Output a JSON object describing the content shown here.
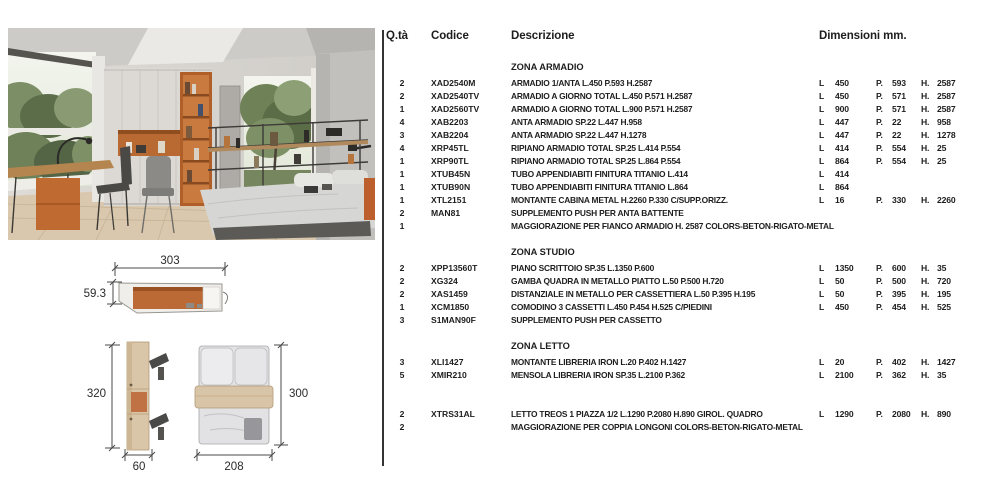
{
  "table": {
    "header": {
      "qty": "Q.tà",
      "code": "Codice",
      "desc": "Descrizione",
      "dims": "Dimensioni mm."
    },
    "dim_labels": {
      "l": "L",
      "p": "P.",
      "h": "H."
    },
    "sections": [
      {
        "title": "ZONA ARMADIO",
        "rows": [
          {
            "qty": "2",
            "code": "XAD2540M",
            "desc": "ARMADIO 1/ANTA  L.450 P.593 H.2587",
            "l": "450",
            "p": "593",
            "h": "2587"
          },
          {
            "qty": "2",
            "code": "XAD2540TV",
            "desc": "ARMADIO A GIORNO TOTAL L.450 P.571 H.2587",
            "l": "450",
            "p": "571",
            "h": "2587"
          },
          {
            "qty": "1",
            "code": "XAD2560TV",
            "desc": "ARMADIO A GIORNO TOTAL L.900 P.571 H.2587",
            "l": "900",
            "p": "571",
            "h": "2587"
          },
          {
            "qty": "4",
            "code": "XAB2203",
            "desc": "ANTA ARMADIO SP.22 L.447 H.958",
            "l": "447",
            "p": "22",
            "h": "958"
          },
          {
            "qty": "3",
            "code": "XAB2204",
            "desc": "ANTA ARMADIO SP.22 L.447 H.1278",
            "l": "447",
            "p": "22",
            "h": "1278"
          },
          {
            "qty": "4",
            "code": "XRP45TL",
            "desc": "RIPIANO ARMADIO TOTAL SP.25 L.414 P.554",
            "l": "414",
            "p": "554",
            "h": "25"
          },
          {
            "qty": "1",
            "code": "XRP90TL",
            "desc": "RIPIANO ARMADIO TOTAL SP.25 L.864 P.554",
            "l": "864",
            "p": "554",
            "h": "25"
          },
          {
            "qty": "1",
            "code": "XTUB45N",
            "desc": "TUBO APPENDIABITI FINITURA TITANIO L.414",
            "l": "414",
            "p": "",
            "h": ""
          },
          {
            "qty": "1",
            "code": "XTUB90N",
            "desc": "TUBO APPENDIABITI FINITURA TITANIO L.864",
            "l": "864",
            "p": "",
            "h": ""
          },
          {
            "qty": "1",
            "code": "XTL2151",
            "desc": "MONTANTE CABINA METAL H.2260 P.330 C/SUPP.ORIZZ.",
            "l": "16",
            "p": "330",
            "h": "2260"
          },
          {
            "qty": "2",
            "code": "MAN81",
            "desc": "SUPPLEMENTO PUSH PER ANTA BATTENTE",
            "l": "",
            "p": "",
            "h": ""
          },
          {
            "qty": "1",
            "code": "",
            "desc": "MAGGIORAZIONE PER FIANCO ARMADIO H. 2587 COLORS-BETON-RIGATO-METAL",
            "l": "",
            "p": "",
            "h": ""
          }
        ]
      },
      {
        "title": "ZONA STUDIO",
        "rows": [
          {
            "qty": "2",
            "code": "XPP13560T",
            "desc": "PIANO SCRITTOIO SP.35 L.1350 P.600",
            "l": "1350",
            "p": "600",
            "h": "35"
          },
          {
            "qty": "2",
            "code": "XG324",
            "desc": "GAMBA QUADRA IN METALLO PIATTO L.50 P.500 H.720",
            "l": "50",
            "p": "500",
            "h": "720"
          },
          {
            "qty": "2",
            "code": "XAS1459",
            "desc": "DISTANZIALE IN METALLO PER CASSETTIERA L.50 P.395 H.195",
            "l": "50",
            "p": "395",
            "h": "195"
          },
          {
            "qty": "1",
            "code": "XCM1850",
            "desc": "COMODINO 3 CASSETTI L.450 P.454 H.525 C/PIEDINI",
            "l": "450",
            "p": "454",
            "h": "525"
          },
          {
            "qty": "3",
            "code": "S1MAN90F",
            "desc": "SUPPLEMENTO PUSH PER CASSETTO",
            "l": "",
            "p": "",
            "h": ""
          }
        ]
      },
      {
        "title": "ZONA LETTO",
        "rows": [
          {
            "qty": "3",
            "code": "XLI1427",
            "desc": "MONTANTE LIBRERIA IRON L.20 P.402 H.1427",
            "l": "20",
            "p": "402",
            "h": "1427"
          },
          {
            "qty": "5",
            "code": "XMIR210",
            "desc": "MENSOLA LIBRERIA IRON SP.35 L.2100 P.362",
            "l": "2100",
            "p": "362",
            "h": "35"
          }
        ]
      },
      {
        "title": "",
        "rows": [
          {
            "qty": "2",
            "code": "XTRS31AL",
            "desc": "LETTO TREOS 1 PIAZZA 1/2 L.1290 P.2080 H.890 GIROL. QUADRO",
            "l": "1290",
            "p": "2080",
            "h": "890"
          },
          {
            "qty": "2",
            "code": "",
            "desc": "MAGGIORAZIONE PER COPPIA LONGONI COLORS-BETON-RIGATO-METAL",
            "l": "",
            "p": "",
            "h": ""
          }
        ]
      }
    ]
  },
  "drawings": {
    "top_view": {
      "width_label": "303",
      "depth_label": "59.3"
    },
    "side_view": {
      "height_label": "320",
      "width_label": "60"
    },
    "bed_top_view": {
      "width_label": "208",
      "height_label": "300"
    }
  },
  "colors": {
    "accent_orange": "#bc6a35",
    "wood_beige": "#d8c3a4",
    "text": "#1d1d1d"
  }
}
